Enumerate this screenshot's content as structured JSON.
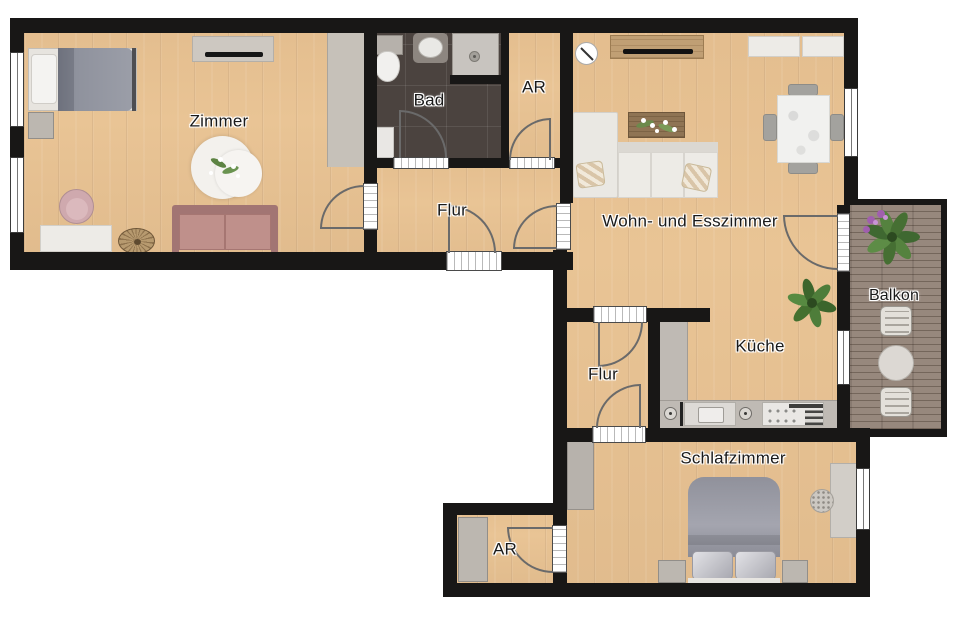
{
  "floorplan": {
    "rooms": [
      {
        "id": "zimmer",
        "label": "Zimmer"
      },
      {
        "id": "bad",
        "label": "Bad"
      },
      {
        "id": "abstellraum_oben",
        "label": "AR"
      },
      {
        "id": "flur_oben",
        "label": "Flur"
      },
      {
        "id": "wohn_esszimmer",
        "label": "Wohn- und Esszimmer"
      },
      {
        "id": "kueche",
        "label": "Küche"
      },
      {
        "id": "flur_unten",
        "label": "Flur"
      },
      {
        "id": "balkon",
        "label": "Balkon"
      },
      {
        "id": "schlafzimmer",
        "label": "Schlafzimmer"
      },
      {
        "id": "abstellraum_unten",
        "label": "AR"
      }
    ],
    "colors": {
      "wall": "#181716",
      "wood": "#e9c495",
      "tile": "#4b433f",
      "deck": "#97887d",
      "arc": "#6a6a6a"
    }
  }
}
